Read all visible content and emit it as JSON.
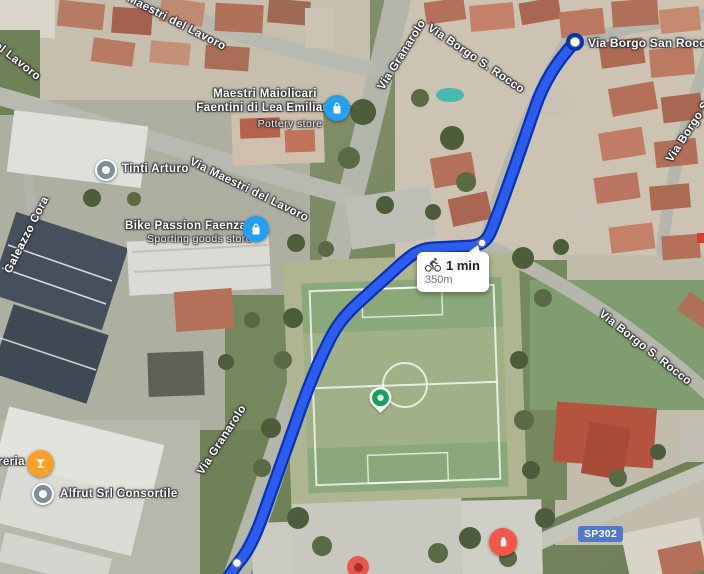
{
  "route": {
    "duration": "1 min",
    "distance": "350m",
    "mode": "bicycle",
    "line_color": "#2d5cf0",
    "casing_color": "#0a33b0"
  },
  "destination_label": "Via Borgo San Rocco",
  "roads": {
    "granarolo_top": "Via Granarolo",
    "granarolo_left": "Via Granarolo",
    "borgo_top": "Via Borgo S. Rocco",
    "borgo_right": "Via Borgo S. Rocco",
    "borgo_edge": "Via Borgo S",
    "maestri_top": "Maestri del Lavoro",
    "maestri_mid": "Via Maestri del Lavoro",
    "del_lavoro": "del Lavoro",
    "galeazzo": "Galeazzo Cora",
    "badge": "SP302",
    "badge_color": "#5377cb"
  },
  "pois": {
    "pottery_line1": "Maestri Maiolicari",
    "pottery_line2": "Faentini di Lea Emiliani",
    "pottery_category": "Pottery store",
    "pottery_icon_color": "#23a0f4",
    "tinti": "Tinti Arturo",
    "bike_name": "Bike Passion Faenza",
    "bike_category": "Sporting goods store",
    "bike_icon_color": "#23a0f4",
    "bar_partial": "reria",
    "bar_icon_color": "#f7a227",
    "alfrut": "Alfrut Srl Consortile",
    "generic_icon_color": "#7e8e96",
    "red_poi_color": "#f4574a",
    "sports_pin_color": "#16a15f"
  }
}
